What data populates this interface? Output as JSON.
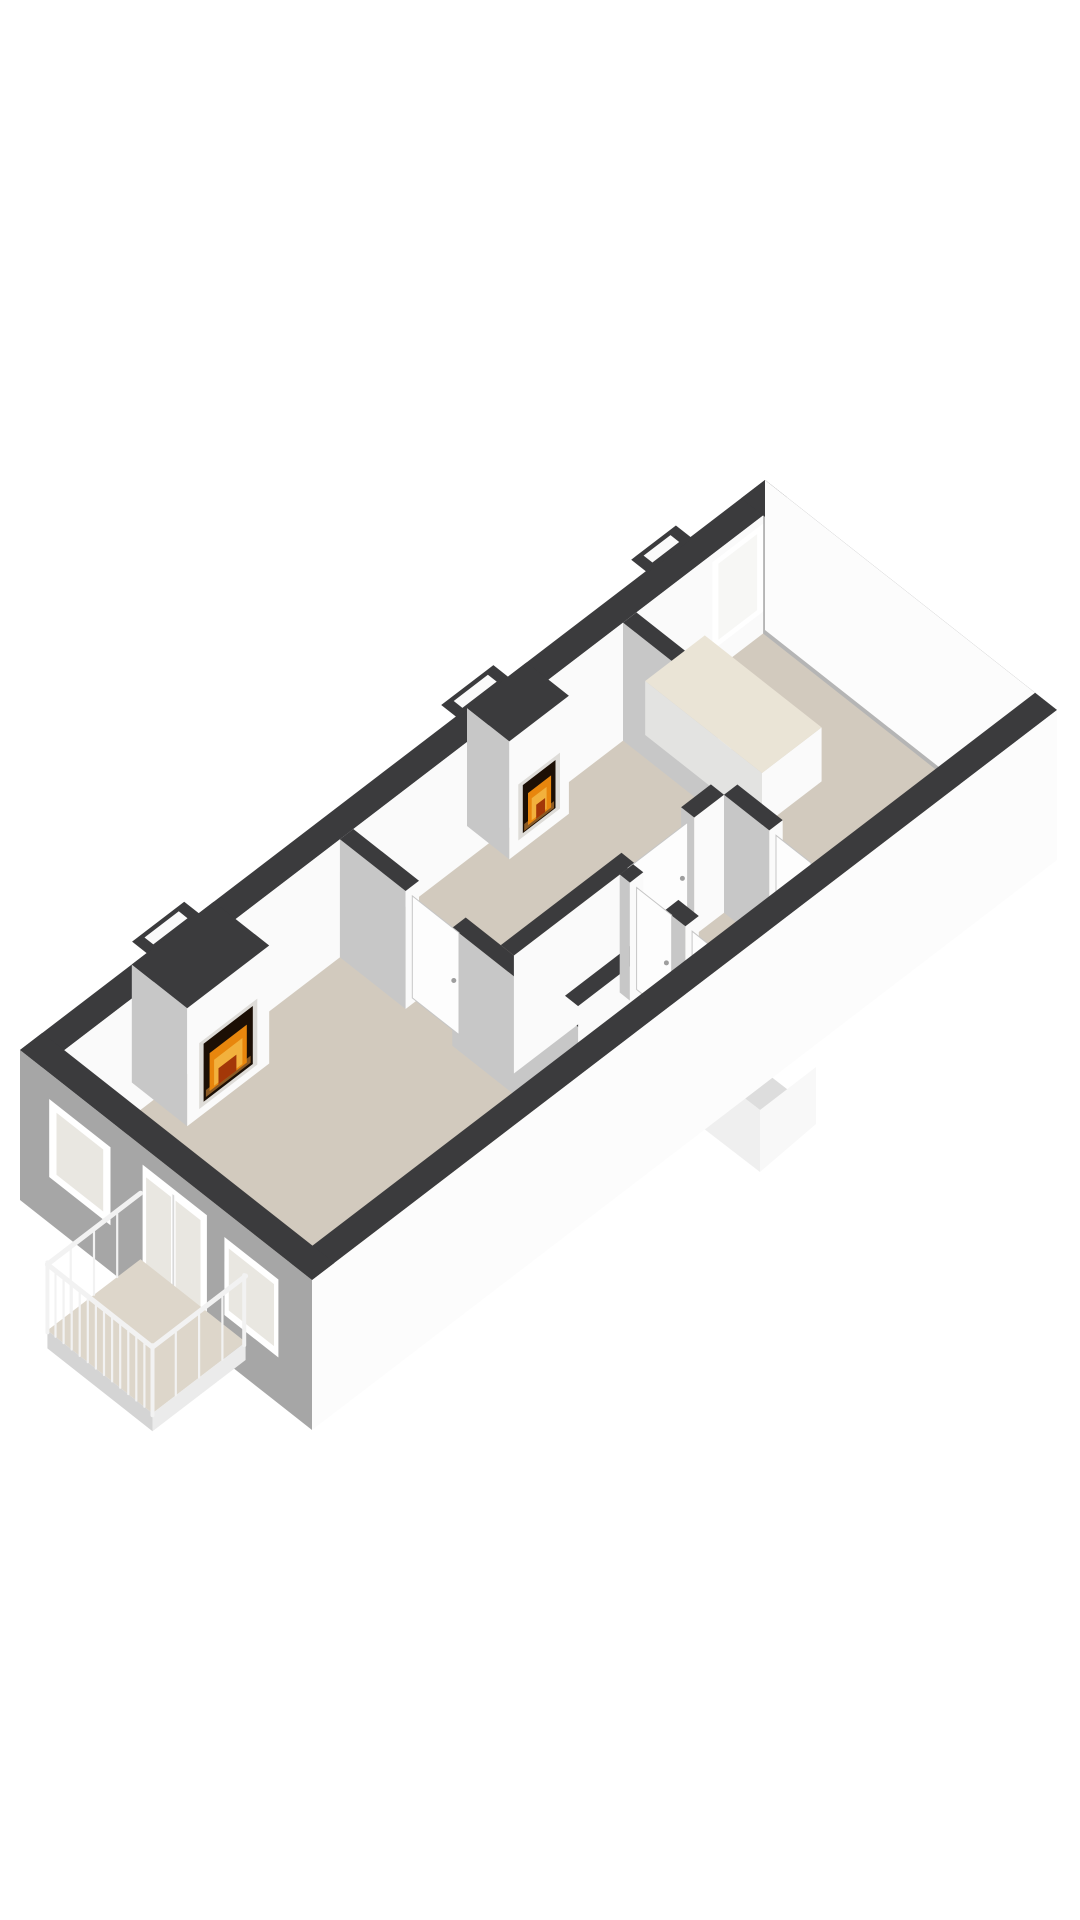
{
  "page": {
    "background": "#FFFFFF",
    "description": "3D axonometric floor plan render of an elongated apartment floor, rotated diagonally on a blank white canvas. No text labels are visible."
  },
  "palette": {
    "background": "#FFFFFF",
    "wall_top": "#3B3B3D",
    "wall_lit": "#FAFAFA",
    "wall_shadow": "#C7C7C7",
    "facade_gray": "#A6A6A6",
    "facade_white": "#FCFCFC",
    "floor": "#D2CABE",
    "balcony_floor": "#DDD6CA",
    "counter_top": "#EAE4D6",
    "counter_face": "#E3E3E1",
    "glass": "#E9E7E1",
    "glass_bright": "#F7F7F5",
    "frame": "#FFFFFF",
    "mullion": "#B5B5B5",
    "door_face": "#FDFDFD",
    "door_stroke": "#C6C6C6",
    "handle": "#9E9E9E",
    "rail": "#F2F2F2",
    "fascia_outer": "#D4D4D4",
    "fascia_front": "#EBEBEB",
    "seam": "#D8D8D8",
    "fire_frame": "#DEDCD8",
    "fire_dark": "#1C0F05",
    "fire_orange": "#E8860D",
    "fire_yellow": "#F2B13D",
    "fire_red": "#A33708",
    "ember": "#8A5A25",
    "flue_side": "#EFEFEF",
    "flue_front": "#F8F8F8",
    "flue_top": "#DDDDDD"
  },
  "floorplan": {
    "style": "3d-axonometric",
    "rotation": "long axis tilted up-right at roughly 37 degrees",
    "rooms": [
      {
        "name": "living-room",
        "position": "left",
        "features": [
          "fireplace",
          "french-doors",
          "balcony-access",
          "two-windows"
        ]
      },
      {
        "name": "sitting-room",
        "position": "center-back",
        "features": [
          "fireplace"
        ]
      },
      {
        "name": "hallway",
        "position": "center-front",
        "features": [
          "doors"
        ]
      },
      {
        "name": "bathroom",
        "position": "center-front",
        "features": [
          "door"
        ]
      },
      {
        "name": "toilet",
        "position": "center-front",
        "features": [
          "door"
        ]
      },
      {
        "name": "kitchen",
        "position": "right-end",
        "features": [
          "counter",
          "window-band",
          "small-back-window"
        ]
      }
    ],
    "fireplaces": [
      {
        "id": "fireplace-1",
        "location": "living-room chimney breast on back wall",
        "state": "lit"
      },
      {
        "id": "fireplace-2",
        "location": "sitting-room chimney breast on back wall",
        "state": "lit"
      }
    ],
    "balcony": {
      "location": "left end facade",
      "railing": "white vertical balusters",
      "access": "french-doors"
    },
    "windows": {
      "left_facade_windows": 2,
      "left_facade_french_doors": 1,
      "right_end_wall_large_panes": 4,
      "right_end_wall_small_window": 1,
      "back_wall_small_window": 1
    },
    "exterior_features": {
      "flue_bumps_on_back_wall": 3,
      "external_flue_below_front_wall": 1,
      "left_facade_finish": "gray",
      "front_wall_finish": "white",
      "wall_tops": "dark charcoal band"
    }
  }
}
